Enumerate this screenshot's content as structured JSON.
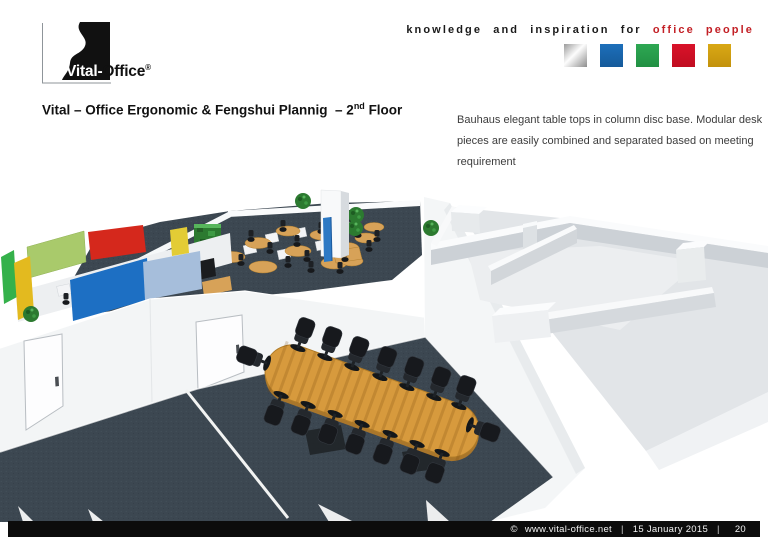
{
  "header": {
    "logo": {
      "brand_left": "Vital-",
      "brand_right": "Office",
      "registered": "®"
    },
    "slogan_black": "knowledge and inspiration for",
    "slogan_red": "office people",
    "swatches": [
      {
        "name": "silver",
        "color": "#c0c0c0"
      },
      {
        "name": "blue",
        "color": "#1a68b2"
      },
      {
        "name": "green",
        "color": "#2aa24c"
      },
      {
        "name": "red",
        "color": "#d50f22"
      },
      {
        "name": "gold",
        "color": "#d6a312"
      }
    ]
  },
  "title": {
    "text": "Vital – Office Ergonomic & Fengshui Plannig  – 2",
    "sup": "nd",
    "tail": " Floor"
  },
  "description": "Bauhaus elegant table tops in column disc base. Modular desk pieces are easily combined and separated based on meeting requirement",
  "scene": {
    "caption": "3D rendering – 2nd floor office plan with open-plan desks, colored acoustic panels and oval conference table",
    "palette": {
      "carpet": "#3c4751",
      "wall": "#f3f5f6",
      "wood_table": "#d79a3d",
      "chair": "#17191d",
      "plant": "#2c7a30",
      "column_accent": "#2d79c4",
      "panel_colors": [
        "#35b14b",
        "#e3ba1f",
        "#a9ca6b",
        "#d5281c",
        "#e3cc35",
        "#1d6fc3",
        "#a6bedb"
      ]
    }
  },
  "footer": {
    "copyright": "©",
    "url": "www.vital-office.net",
    "sep": "|",
    "date": "15 January 2015",
    "page": "20"
  }
}
